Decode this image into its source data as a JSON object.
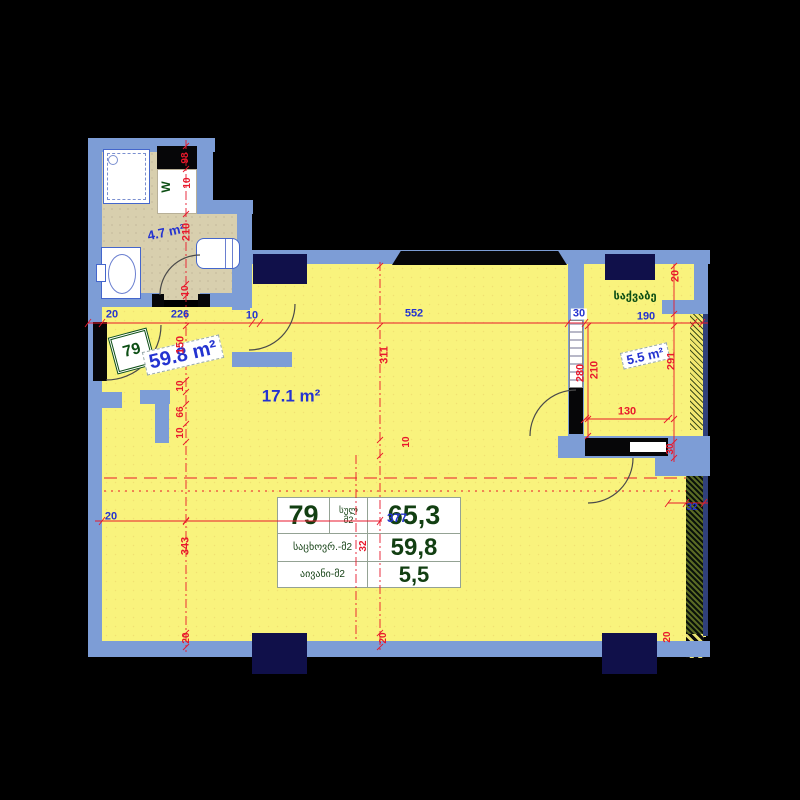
{
  "colors": {
    "red": "#e8192c",
    "blue": "#2433d0",
    "green": "#0c4e14",
    "wall": "#7d9dd6",
    "floor": "#f9f37d",
    "bath_floor": "#d8cfae",
    "column": "#10104a"
  },
  "plan": {
    "entry_number": "79",
    "washer_label": "W",
    "boiler_room_label": "საქვაბე"
  },
  "table": {
    "number": "79",
    "rows": [
      {
        "label": "სულ",
        "unit": "მ2",
        "value": "65,3"
      },
      {
        "label": "საცხოვრ.-მ2",
        "value": "59,8"
      },
      {
        "label": "აივანი-მ2",
        "value": "5,5"
      }
    ]
  },
  "annotations": [
    {
      "text": "20",
      "x": 112,
      "y": 315,
      "color": "blue",
      "name": "dim-20-top-left"
    },
    {
      "text": "226",
      "x": 180,
      "y": 315,
      "color": "blue",
      "name": "dim-226"
    },
    {
      "text": "10",
      "x": 252,
      "y": 316,
      "color": "blue",
      "name": "dim-10-top"
    },
    {
      "text": "552",
      "x": 414,
      "y": 314,
      "color": "blue",
      "name": "dim-552"
    },
    {
      "text": "30",
      "x": 579,
      "y": 314,
      "color": "blue",
      "cls": "wb",
      "name": "dim-30-top"
    },
    {
      "text": "190",
      "x": 646,
      "y": 317,
      "color": "blue",
      "name": "dim-190"
    },
    {
      "text": "20",
      "x": 111,
      "y": 517,
      "color": "blue",
      "name": "dim-20-mid-left"
    },
    {
      "text": "32",
      "x": 692,
      "y": 508,
      "color": "blue",
      "fs": 10,
      "name": "dim-32-right"
    },
    {
      "text": "377",
      "x": 397,
      "y": 518,
      "color": "blue",
      "fs": 12,
      "name": "dim-377-overlap"
    },
    {
      "text": "4.7 m²",
      "x": 166,
      "y": 232,
      "color": "blue",
      "fs": 13,
      "rot": -12,
      "name": "area-bathroom"
    },
    {
      "text": "17.1 m²",
      "x": 291,
      "y": 396,
      "color": "blue",
      "fs": 17,
      "name": "area-room"
    },
    {
      "text": "59.8 m²",
      "x": 183,
      "y": 355,
      "color": "blue",
      "fs": 20,
      "rot": -13,
      "cls": "whitebox",
      "name": "area-living"
    },
    {
      "text": "5.5 m²",
      "x": 645,
      "y": 356,
      "color": "blue",
      "fs": 13,
      "rot": -13,
      "cls": "whitebox",
      "name": "area-boiler"
    },
    {
      "text": "98",
      "x": 186,
      "y": 158,
      "rot": -90,
      "fs": 10,
      "name": "dim-98-vent"
    },
    {
      "text": "10",
      "x": 188,
      "y": 183,
      "rot": -90,
      "fs": 10,
      "name": "dim-10-bath-a"
    },
    {
      "text": "210",
      "x": 187,
      "y": 232,
      "rot": -90,
      "name": "dim-210-bath"
    },
    {
      "text": "10",
      "x": 186,
      "y": 291,
      "rot": -90,
      "fs": 10,
      "name": "dim-10-bath-b"
    },
    {
      "text": "150",
      "x": 181,
      "y": 345,
      "rot": -90,
      "name": "dim-150"
    },
    {
      "text": "10",
      "x": 181,
      "y": 386,
      "rot": -90,
      "fs": 10,
      "name": "dim-10-hall-a"
    },
    {
      "text": "66",
      "x": 181,
      "y": 412,
      "rot": -90,
      "fs": 10,
      "name": "dim-66"
    },
    {
      "text": "10",
      "x": 181,
      "y": 433,
      "rot": -90,
      "fs": 10,
      "name": "dim-10-hall-b"
    },
    {
      "text": "343",
      "x": 186,
      "y": 546,
      "rot": -90,
      "name": "dim-343"
    },
    {
      "text": "20",
      "x": 187,
      "y": 638,
      "rot": -90,
      "fs": 10,
      "name": "dim-20-bottom-left"
    },
    {
      "text": "311",
      "x": 385,
      "y": 355,
      "rot": -90,
      "name": "dim-311"
    },
    {
      "text": "10",
      "x": 407,
      "y": 442,
      "rot": -90,
      "fs": 10,
      "name": "dim-10-room"
    },
    {
      "text": "20",
      "x": 384,
      "y": 638,
      "rot": -90,
      "fs": 10,
      "name": "dim-20-bottom-mid"
    },
    {
      "text": "20",
      "x": 676,
      "y": 276,
      "rot": -90,
      "name": "dim-20-top-right"
    },
    {
      "text": "280",
      "x": 581,
      "y": 373,
      "rot": -90,
      "name": "dim-280"
    },
    {
      "text": "210",
      "x": 595,
      "y": 370,
      "rot": -90,
      "name": "dim-210-boiler"
    },
    {
      "text": "291",
      "x": 672,
      "y": 361,
      "rot": -90,
      "name": "dim-291"
    },
    {
      "text": "130",
      "x": 627,
      "y": 412,
      "name": "dim-130"
    },
    {
      "text": "30",
      "x": 671,
      "y": 449,
      "rot": -90,
      "fs": 10,
      "name": "dim-30-right"
    },
    {
      "text": "20",
      "x": 668,
      "y": 637,
      "rot": -90,
      "fs": 10,
      "name": "dim-20-bottom-right"
    },
    {
      "text": "32",
      "x": 364,
      "y": 546,
      "rot": -90,
      "fs": 10,
      "name": "dim-32-overlap"
    },
    {
      "text": "W",
      "x": 166,
      "y": 187,
      "color": "green",
      "rot": -90,
      "fs": 12,
      "name": "washer-label"
    },
    {
      "text": "საქვაბე",
      "x": 635,
      "y": 297,
      "color": "green",
      "fs": 11,
      "name": "boiler-room-label"
    }
  ]
}
